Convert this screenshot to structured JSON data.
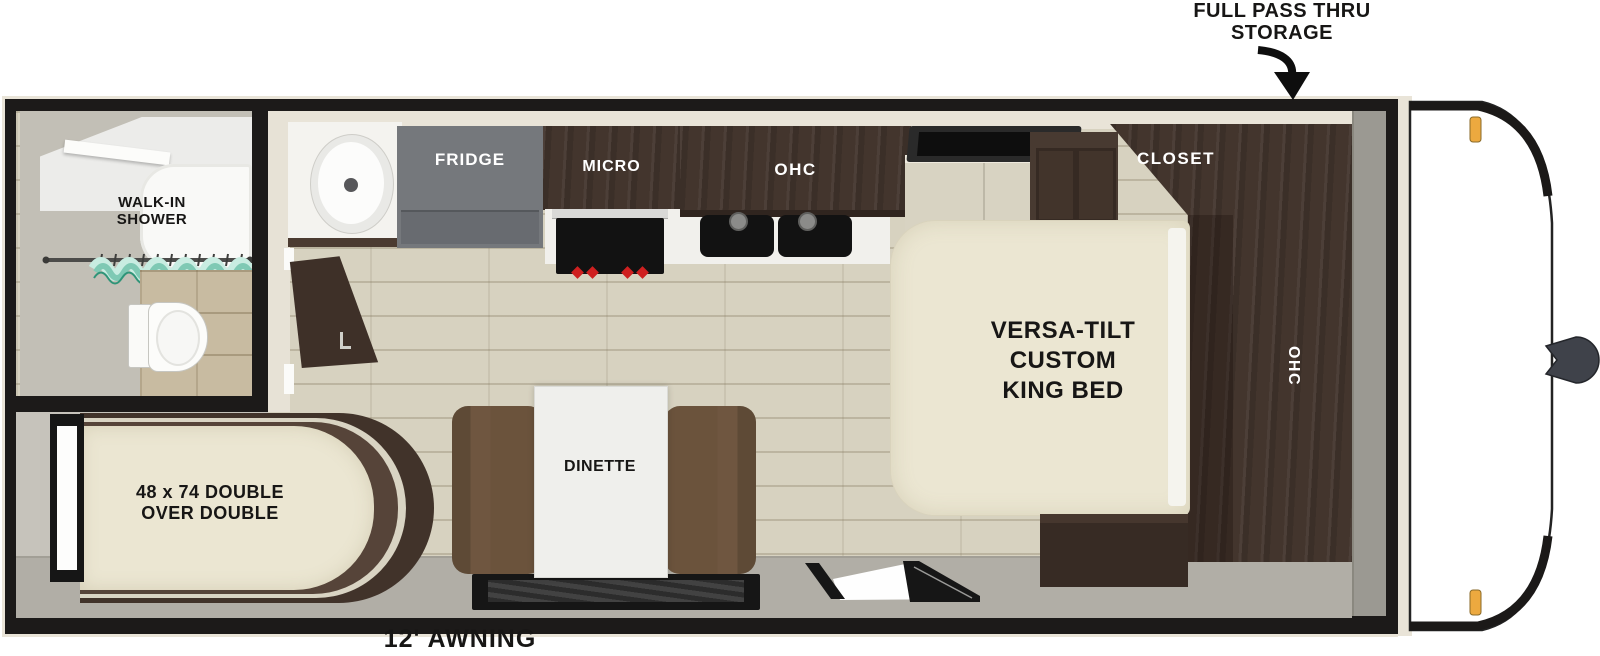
{
  "callouts": {
    "pass_thru_line1": "FULL PASS THRU",
    "pass_thru_line2": "STORAGE",
    "awning": "12' AWNING"
  },
  "bathroom": {
    "shower_line1": "WALK-IN",
    "shower_line2": "SHOWER"
  },
  "bunk_room": {
    "bed_line1": "48 x 74 DOUBLE",
    "bed_line2": "OVER DOUBLE"
  },
  "kitchen": {
    "fridge": "FRIDGE",
    "micro": "MICRO",
    "ohc": "OHC"
  },
  "bedroom": {
    "closet": "CLOSET",
    "wardrobe_ohc": "OHC",
    "bed_line1": "VERSA-TILT",
    "bed_line2": "CUSTOM",
    "bed_line3": "KING BED"
  },
  "dinette": {
    "label": "DINETTE"
  },
  "colors": {
    "wall_black": "#1c1a19",
    "trim_cream": "#e9e4d8",
    "wood_floor": "#d7d2c0",
    "walkway_gray": "#b1aea6",
    "cabinet_wood_dark": "#43352d",
    "fridge_gray": "#75787c",
    "bench_brown": "#6b533c",
    "mattress_cream": "#ebe6d2",
    "curtain_teal": "#7fc9b4",
    "marker_amber": "#eca93f",
    "knob_red": "#cf2020"
  }
}
